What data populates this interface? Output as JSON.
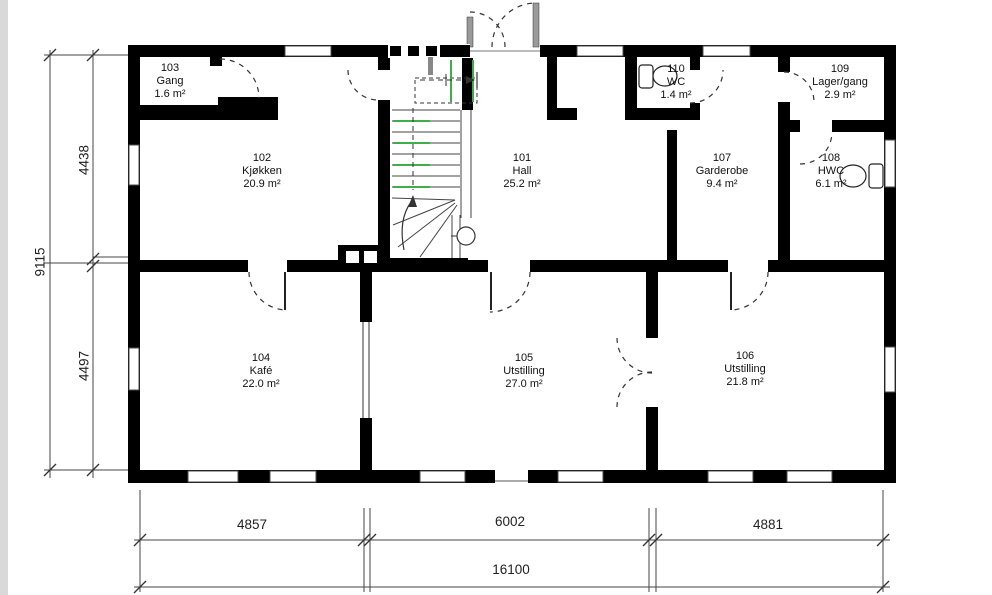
{
  "drawing_type": "floor plan",
  "colors": {
    "wall": "#000000",
    "line": "#444444",
    "stair_accent_green": "#3fae49",
    "background": "#ffffff",
    "margin_strip": "#d9d9d9"
  },
  "rooms": [
    {
      "id": "101",
      "name": "Hall",
      "area": "25.2 m²"
    },
    {
      "id": "102",
      "name": "Kjøkken",
      "area": "20.9 m²"
    },
    {
      "id": "103",
      "name": "Gang",
      "area": "1.6 m²"
    },
    {
      "id": "104",
      "name": "Kafé",
      "area": "22.0 m²"
    },
    {
      "id": "105",
      "name": "Utstilling",
      "area": "27.0 m²"
    },
    {
      "id": "106",
      "name": "Utstilling",
      "area": "21.8 m²"
    },
    {
      "id": "107",
      "name": "Garderobe",
      "area": "9.4 m²"
    },
    {
      "id": "108",
      "name": "HWC",
      "area": "6.1 m²"
    },
    {
      "id": "109",
      "name": "Lager/gang",
      "area": "2.9 m²"
    },
    {
      "id": "110",
      "name": "WC",
      "area": "1.4 m²"
    }
  ],
  "dimensions": {
    "left_top": "4438",
    "left_total": "9115",
    "left_bottom": "4497",
    "bottom_left": "4857",
    "bottom_mid": "6002",
    "bottom_right": "4881",
    "bottom_total": "16100"
  }
}
